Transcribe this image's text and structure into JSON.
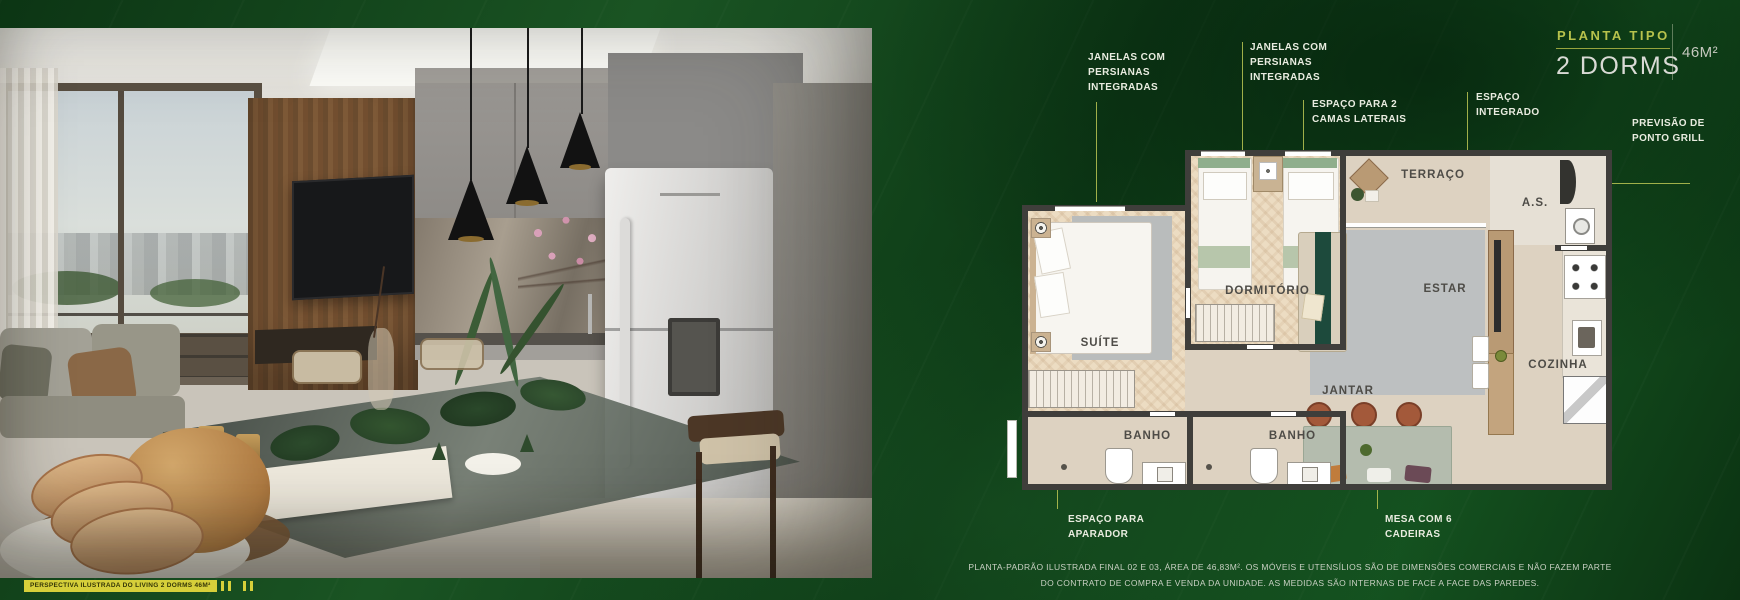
{
  "header": {
    "eyebrow": "PLANTA TIPO",
    "title": "2 DORMS",
    "area": "46M²"
  },
  "callouts": {
    "windows_left": "JANELAS COM PERSIANAS INTEGRADAS",
    "windows_mid": "JANELAS COM PERSIANAS INTEGRADAS",
    "side_beds": "ESPAÇO PARA 2 CAMAS LATERAIS",
    "integrated_space": "ESPAÇO INTEGRADO",
    "grill": "PREVISÃO DE PONTO GRILL",
    "sideboard": "ESPAÇO PARA APARADOR",
    "table": "MESA COM 6 CADEIRAS"
  },
  "plan": {
    "rooms": {
      "suite": "SUÍTE",
      "dormitorio": "DORMITÓRIO",
      "terraco": "TERRAÇO",
      "as": "A.S.",
      "estar": "ESTAR",
      "cozinha": "COZINHA",
      "jantar": "JANTAR",
      "banho1": "BANHO",
      "banho2": "BANHO"
    }
  },
  "caption": "PERSPECTIVA ILUSTRADA DO LIVING 2 DORMS 46M²",
  "disclaimer": {
    "line1": "PLANTA-PADRÃO ILUSTRADA FINAL 02 E 03, ÁREA DE 46,83M². OS MÓVEIS E UTENSÍLIOS SÃO DE DIMENSÕES COMERCIAIS E NÃO FAZEM PARTE",
    "line2": "DO CONTRATO DE COMPRA E VENDA DA UNIDADE. AS MEDIDAS SÃO INTERNAS DE FACE A FACE DAS PAREDES."
  },
  "colors": {
    "accent": "#b7c24c",
    "background": "#0d3a16",
    "wall": "#3f3e3b",
    "floor": "#ddd2c1",
    "wood_floor": "#ecdcc2",
    "label_text": "#4e4c47",
    "callout_text": "#e9ece0"
  }
}
